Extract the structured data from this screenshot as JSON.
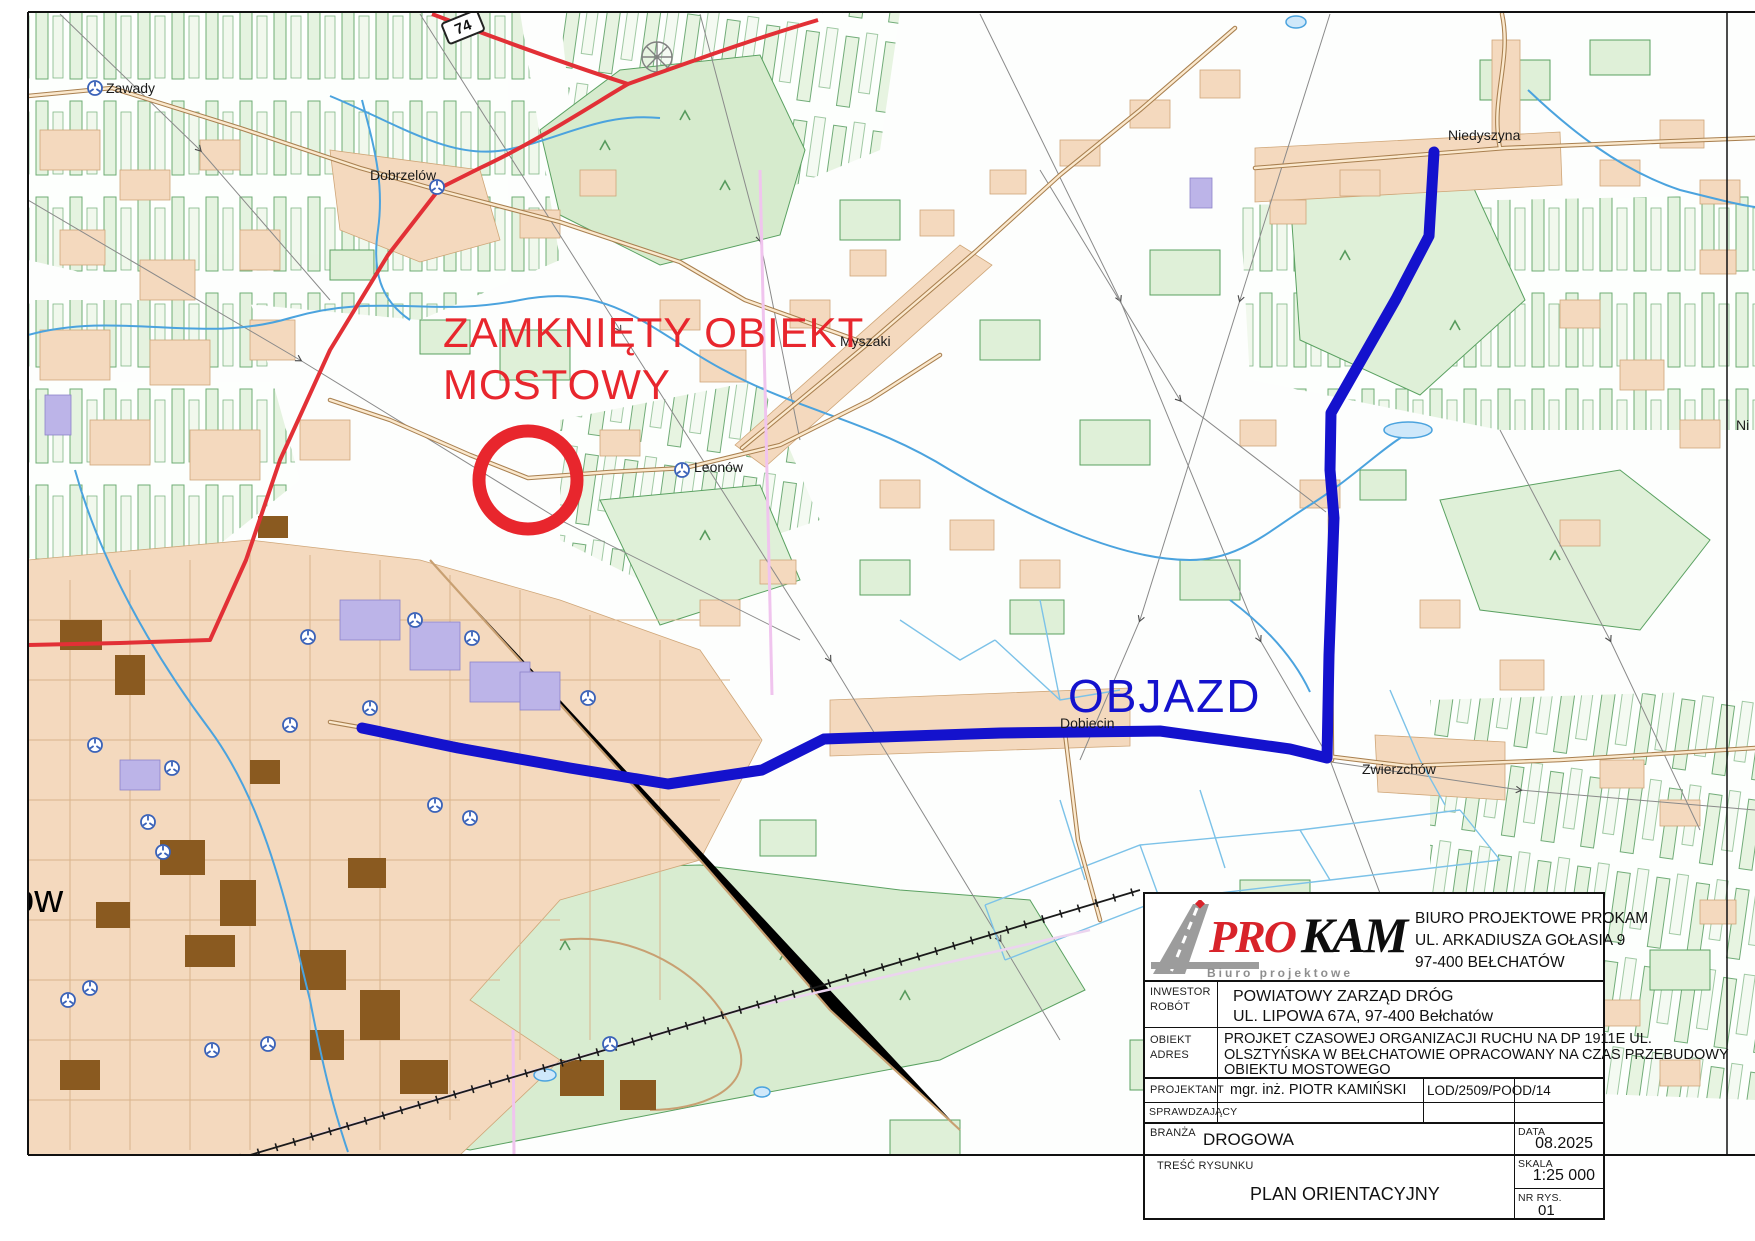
{
  "map": {
    "labels": {
      "zawady": "Zawady",
      "dobrzelow": "Dobrzelów",
      "myszaki": "Myszaki",
      "leonow": "Leonów",
      "niedyszyna": "Niedyszyna",
      "dobiecin": "Dobiecin",
      "zwierzchow": "Zwierzchów",
      "city_partial": "ów",
      "right_partial": "Ni"
    },
    "annotations": {
      "closed_line1": "ZAMKNIĘTY OBIEKT",
      "closed_line2": "MOSTOWY",
      "detour": "OBJAZD",
      "road_shield": "74"
    },
    "colors": {
      "closed_red": "#e8262d",
      "detour_blue": "#1412cd",
      "water_blue": "#4ba3de",
      "forest_green": "#dff0d8",
      "builtup_peach": "#f4d9be"
    }
  },
  "title_block": {
    "logo": {
      "pro": "PRO",
      "kam": "KAM",
      "tagline": "Biuro projektowe"
    },
    "company": {
      "lines": [
        "BIURO PROJEKTOWE PROKAM",
        "UL. ARKADIUSZA GOŁASIA 9",
        "97-400 BEŁCHATÓW"
      ]
    },
    "inwestor": {
      "label1": "INWESTOR",
      "label2": "ROBÓT",
      "lines": [
        "POWIATOWY ZARZĄD DRÓG",
        "UL. LIPOWA 67A, 97-400 Bełchatów"
      ]
    },
    "obiekt": {
      "label1": "OBIEKT",
      "label2": "ADRES",
      "lines": [
        "PROJKET CZASOWEJ ORGANIZACJI RUCHU NA DP 1911E UL.",
        "OLSZTYŃSKA W BEŁCHATOWIE OPRACOWANY NA CZAS PRZEBUDOWY",
        "OBIEKTU MOSTOWEGO"
      ]
    },
    "projektant": {
      "label": "PROJEKTANT",
      "name": "mgr. inż. PIOTR KAMIŃSKI",
      "cert": "LOD/2509/POOD/14"
    },
    "sprawdzajacy": {
      "label": "SPRAWDZAJĄCY"
    },
    "branza": {
      "label": "BRANŻA",
      "value": "DROGOWA"
    },
    "tresc": {
      "label": "TREŚĆ RYSUNKU",
      "value": "PLAN ORIENTACYJNY"
    },
    "data": {
      "label": "DATA",
      "value": "08.2025"
    },
    "skala": {
      "label": "SKALA",
      "value": "1:25 000"
    },
    "nr": {
      "label": "NR RYS.",
      "value": "01"
    }
  }
}
